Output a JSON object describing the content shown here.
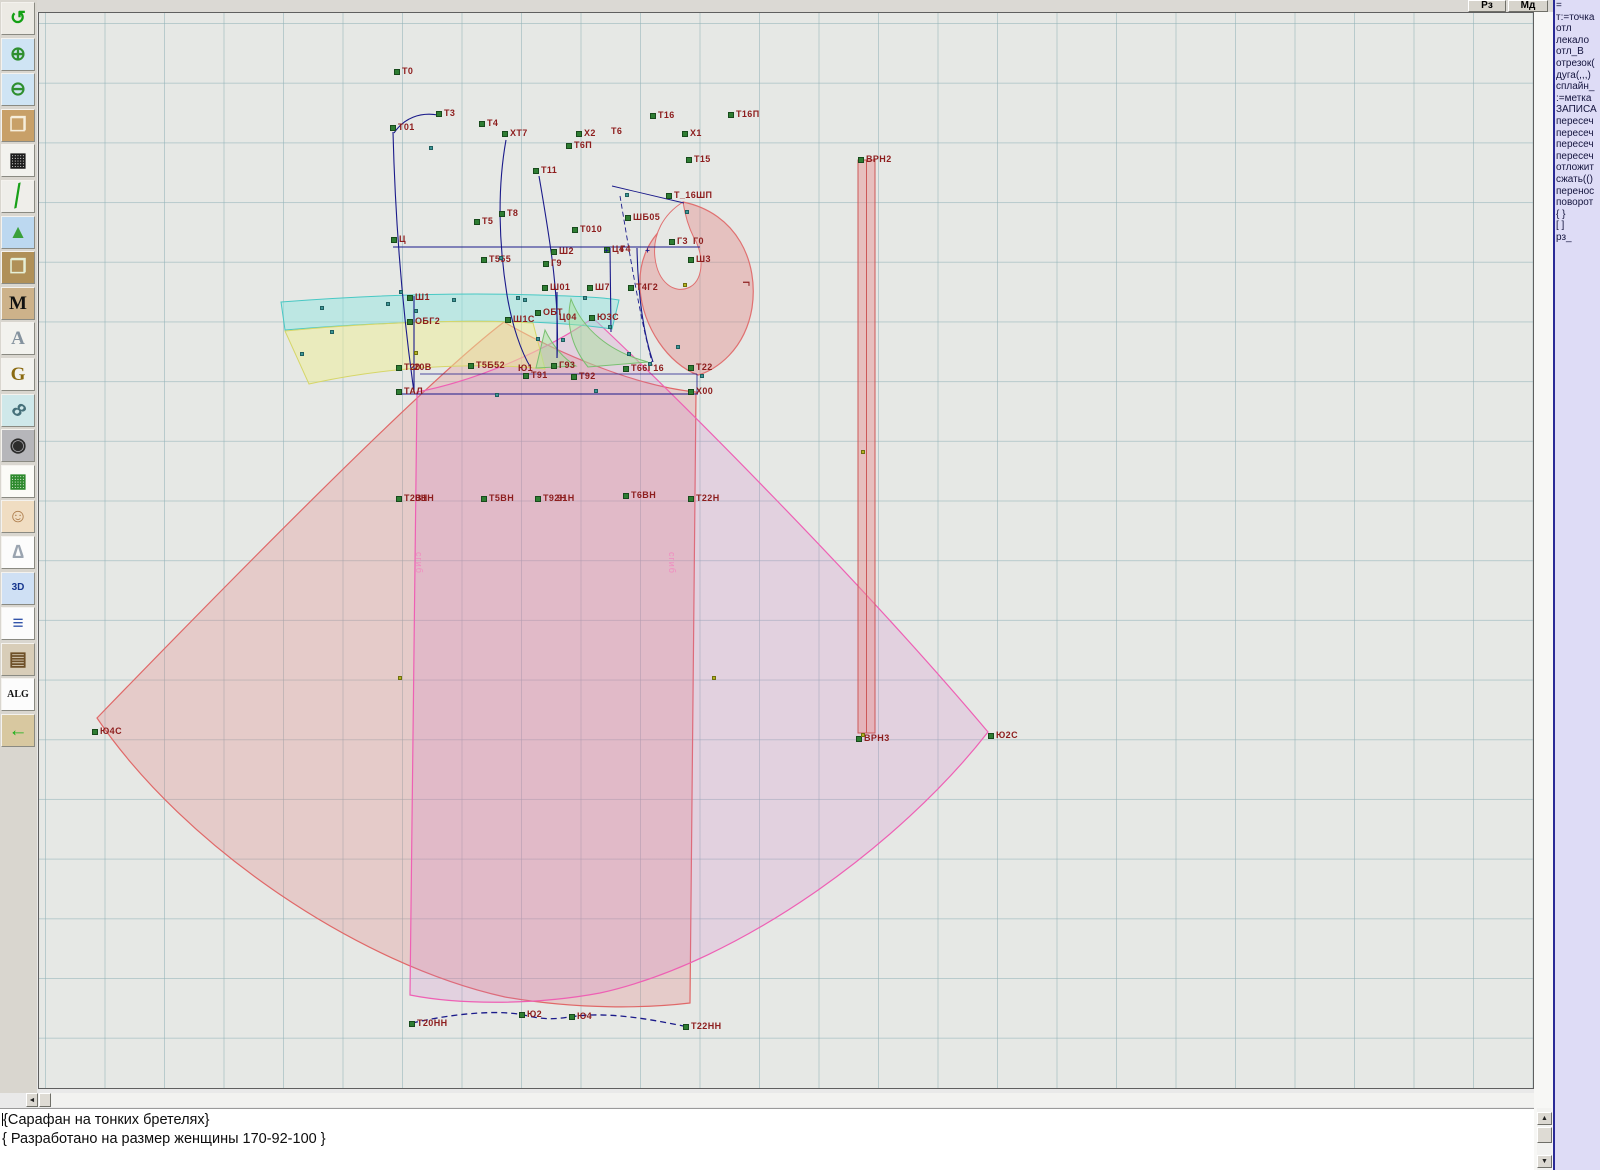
{
  "window": {
    "title": "Pattern CAD workspace"
  },
  "topbar": {
    "buttons": [
      {
        "label": "Рз"
      },
      {
        "label": "Мд"
      }
    ]
  },
  "toolbar": {
    "items": [
      {
        "name": "undo-icon",
        "glyph": "↺",
        "fg": "#14a014",
        "bg": "#eceae4",
        "cls": ""
      },
      {
        "name": "zoom-in-icon",
        "glyph": "⊕",
        "fg": "#2f8f2f",
        "bg": "#cfe4f4",
        "cls": ""
      },
      {
        "name": "zoom-out-icon",
        "glyph": "⊖",
        "fg": "#2f8f2f",
        "bg": "#cfe4f4",
        "cls": ""
      },
      {
        "name": "piece-preview-icon",
        "glyph": "❐",
        "fg": "#f6eedc",
        "bg": "#c8a068",
        "cls": ""
      },
      {
        "name": "grid-icon",
        "glyph": "▦",
        "fg": "#1c1c1c",
        "bg": "#f2f2ee",
        "cls": ""
      },
      {
        "name": "segment-icon",
        "glyph": "╱",
        "fg": "#18a018",
        "bg": "#efeeea",
        "cls": "seg"
      },
      {
        "name": "image-icon",
        "glyph": "▲",
        "fg": "#3aa03a",
        "bg": "#bcd8f0",
        "cls": ""
      },
      {
        "name": "pattern-piece-icon",
        "glyph": "❐",
        "fg": "#e6f0d8",
        "bg": "#b09058",
        "cls": ""
      },
      {
        "name": "measure-m-icon",
        "glyph": "M",
        "fg": "#111111",
        "bg": "#cdb28a",
        "cls": "serif"
      },
      {
        "name": "compass-a-icon",
        "glyph": "A",
        "fg": "#84929e",
        "bg": "#f2f2ee",
        "cls": "serif"
      },
      {
        "name": "compass-g-icon",
        "glyph": "G",
        "fg": "#8a6a10",
        "bg": "#f2f2ee",
        "cls": "serif"
      },
      {
        "name": "ruler-icon",
        "glyph": "8",
        "fg": "#46707a",
        "bg": "#cfe8ea",
        "cls": "ruler"
      },
      {
        "name": "camera-icon",
        "glyph": "◉",
        "fg": "#2c2c2c",
        "bg": "#b6b6ba",
        "cls": ""
      },
      {
        "name": "table-icon",
        "glyph": "▦",
        "fg": "#2d8a2d",
        "bg": "#fbfbf7",
        "cls": ""
      },
      {
        "name": "model-photo-icon",
        "glyph": "☺",
        "fg": "#b08050",
        "bg": "#f0ddc2",
        "cls": ""
      },
      {
        "name": "garment-icon",
        "glyph": "∆",
        "fg": "#9aa4b0",
        "bg": "#fcfcfc",
        "cls": ""
      },
      {
        "name": "threed-icon",
        "glyph": "3D",
        "fg": "#16368e",
        "bg": "#cfe0f4",
        "cls": "small"
      },
      {
        "name": "text-list-icon",
        "glyph": "≡",
        "fg": "#3355aa",
        "bg": "#fcfcfc",
        "cls": ""
      },
      {
        "name": "books-icon",
        "glyph": "▤",
        "fg": "#6e5028",
        "bg": "#d8cdb8",
        "cls": ""
      },
      {
        "name": "alg-icon",
        "glyph": "ALG",
        "fg": "#111111",
        "bg": "#fcfcfc",
        "cls": "small serif"
      },
      {
        "name": "exit-icon",
        "glyph": "←",
        "fg": "#18b018",
        "bg": "#d8c8a0",
        "cls": ""
      }
    ]
  },
  "command_panel": {
    "lines": [
      "=",
      "т:=точка",
      "отл",
      "лекало",
      "отл_В",
      "отрезок(",
      "дуга(,,,)",
      "сплайн_",
      ":=метка",
      "ЗАПИСА",
      "пересеч",
      "пересеч",
      "пересеч",
      "пересеч",
      "отложит",
      "сжать(()",
      "перенос",
      "поворот",
      "{ }",
      "[ ]",
      "рз_"
    ]
  },
  "status": {
    "line1": "{Сарафан на тонких бретелях}",
    "line2": "{ Разработано на размер женщины 170-92-100 }"
  },
  "canvas": {
    "fold_label": "сгиб",
    "fold_positions": [
      {
        "x": 424,
        "y": 552
      },
      {
        "x": 677,
        "y": 552
      }
    ],
    "labels": [
      {
        "t": "Т0",
        "x": 394,
        "y": 70
      },
      {
        "t": "Т3",
        "x": 436,
        "y": 112
      },
      {
        "t": "Т01",
        "x": 390,
        "y": 126
      },
      {
        "t": "Т4",
        "x": 479,
        "y": 122
      },
      {
        "t": "ХТ7",
        "x": 502,
        "y": 132
      },
      {
        "t": "Х2",
        "x": 576,
        "y": 132
      },
      {
        "t": "Т6П",
        "x": 566,
        "y": 144
      },
      {
        "t": "Т6",
        "x": 611,
        "y": 130,
        "m": 0
      },
      {
        "t": "Т16",
        "x": 650,
        "y": 114
      },
      {
        "t": "Т16П",
        "x": 728,
        "y": 113
      },
      {
        "t": "Х1",
        "x": 682,
        "y": 132
      },
      {
        "t": "Т15",
        "x": 686,
        "y": 158
      },
      {
        "t": "Т11",
        "x": 533,
        "y": 169
      },
      {
        "t": "Т8",
        "x": 499,
        "y": 212
      },
      {
        "t": "Т5",
        "x": 474,
        "y": 220
      },
      {
        "t": "Т_16ШП",
        "x": 666,
        "y": 194
      },
      {
        "t": "ШБ05",
        "x": 625,
        "y": 216
      },
      {
        "t": "Т010",
        "x": 572,
        "y": 228
      },
      {
        "t": "Ц",
        "x": 391,
        "y": 238
      },
      {
        "t": "Ш2",
        "x": 551,
        "y": 250
      },
      {
        "t": "Ц4",
        "x": 604,
        "y": 248
      },
      {
        "t": "Г4",
        "x": 620,
        "y": 248,
        "m": 0
      },
      {
        "t": "Г3",
        "x": 669,
        "y": 240
      },
      {
        "t": "Г0",
        "x": 693,
        "y": 240,
        "m": 0
      },
      {
        "t": "Ш3",
        "x": 688,
        "y": 258
      },
      {
        "t": "Т555",
        "x": 481,
        "y": 258
      },
      {
        "t": "Г9",
        "x": 543,
        "y": 262
      },
      {
        "t": "Ш01",
        "x": 542,
        "y": 286
      },
      {
        "t": "Ш7",
        "x": 587,
        "y": 286
      },
      {
        "t": "Т4Г2",
        "x": 628,
        "y": 286
      },
      {
        "t": "Ш1",
        "x": 407,
        "y": 296
      },
      {
        "t": "ОБГ2",
        "x": 407,
        "y": 320
      },
      {
        "t": "Ш1С",
        "x": 505,
        "y": 318
      },
      {
        "t": "ОБТ",
        "x": 535,
        "y": 311
      },
      {
        "t": "Ц04",
        "x": 559,
        "y": 316,
        "m": 0
      },
      {
        "t": "Ю3С",
        "x": 589,
        "y": 316
      },
      {
        "t": "Т20",
        "x": 396,
        "y": 366
      },
      {
        "t": "20В",
        "x": 414,
        "y": 366,
        "m": 0
      },
      {
        "t": "Т5Б52",
        "x": 468,
        "y": 364
      },
      {
        "t": "Ю1",
        "x": 518,
        "y": 367,
        "m": 0
      },
      {
        "t": "Т91",
        "x": 523,
        "y": 374
      },
      {
        "t": "Г93",
        "x": 551,
        "y": 364
      },
      {
        "t": "Т92",
        "x": 571,
        "y": 375
      },
      {
        "t": "Т66Г16",
        "x": 623,
        "y": 367
      },
      {
        "t": "Т22",
        "x": 688,
        "y": 366
      },
      {
        "t": "ТАЛ",
        "x": 396,
        "y": 390
      },
      {
        "t": "Х00",
        "x": 688,
        "y": 390
      },
      {
        "t": "Г",
        "x": 750,
        "y": 284,
        "m": 0,
        "rot": 90
      },
      {
        "t": "ВРН2",
        "x": 858,
        "y": 158
      },
      {
        "t": "Т20Н",
        "x": 396,
        "y": 497
      },
      {
        "t": "В1Н",
        "x": 415,
        "y": 497,
        "m": 0
      },
      {
        "t": "Т5ВН",
        "x": 481,
        "y": 497
      },
      {
        "t": "Т92Н",
        "x": 535,
        "y": 497
      },
      {
        "t": "91Н",
        "x": 557,
        "y": 497,
        "m": 0
      },
      {
        "t": "Т6ВН",
        "x": 623,
        "y": 494
      },
      {
        "t": "Т22Н",
        "x": 688,
        "y": 497
      },
      {
        "t": "Ю4С",
        "x": 92,
        "y": 730
      },
      {
        "t": "Ю2С",
        "x": 988,
        "y": 734
      },
      {
        "t": "ВРН3",
        "x": 856,
        "y": 737
      },
      {
        "t": "Т20НН",
        "x": 409,
        "y": 1022
      },
      {
        "t": "Ю2",
        "x": 519,
        "y": 1013
      },
      {
        "t": "Ю4",
        "x": 569,
        "y": 1015
      },
      {
        "t": "Т22НН",
        "x": 683,
        "y": 1025
      }
    ],
    "teal_points": [
      {
        "x": 320,
        "y": 306
      },
      {
        "x": 386,
        "y": 302
      },
      {
        "x": 452,
        "y": 298
      },
      {
        "x": 516,
        "y": 296
      },
      {
        "x": 583,
        "y": 296
      },
      {
        "x": 414,
        "y": 309
      },
      {
        "x": 300,
        "y": 352
      },
      {
        "x": 330,
        "y": 330
      },
      {
        "x": 499,
        "y": 256
      },
      {
        "x": 523,
        "y": 298
      },
      {
        "x": 536,
        "y": 337
      },
      {
        "x": 561,
        "y": 338
      },
      {
        "x": 608,
        "y": 325
      },
      {
        "x": 627,
        "y": 352
      },
      {
        "x": 648,
        "y": 362
      },
      {
        "x": 676,
        "y": 345
      },
      {
        "x": 700,
        "y": 374
      },
      {
        "x": 594,
        "y": 389
      },
      {
        "x": 495,
        "y": 393
      },
      {
        "x": 625,
        "y": 193
      },
      {
        "x": 685,
        "y": 210
      },
      {
        "x": 429,
        "y": 146
      },
      {
        "x": 399,
        "y": 290
      }
    ],
    "olive_points": [
      {
        "x": 398,
        "y": 676
      },
      {
        "x": 712,
        "y": 676
      },
      {
        "x": 861,
        "y": 733
      },
      {
        "x": 683,
        "y": 283
      },
      {
        "x": 414,
        "y": 351
      },
      {
        "x": 861,
        "y": 450
      }
    ],
    "cross_points": [
      {
        "x": 604,
        "y": 249
      },
      {
        "x": 645,
        "y": 249
      }
    ]
  },
  "colors": {
    "label": "#8d1d1d",
    "navy": "#1a1a8a",
    "left_petal_stroke": "#e06868",
    "right_petal_stroke": "#ee60b4",
    "cyan_stroke": "#48c8c4",
    "yellow_stroke": "#d6d668",
    "green_stroke": "#78c070",
    "panel_bg": "#dedcf6"
  }
}
